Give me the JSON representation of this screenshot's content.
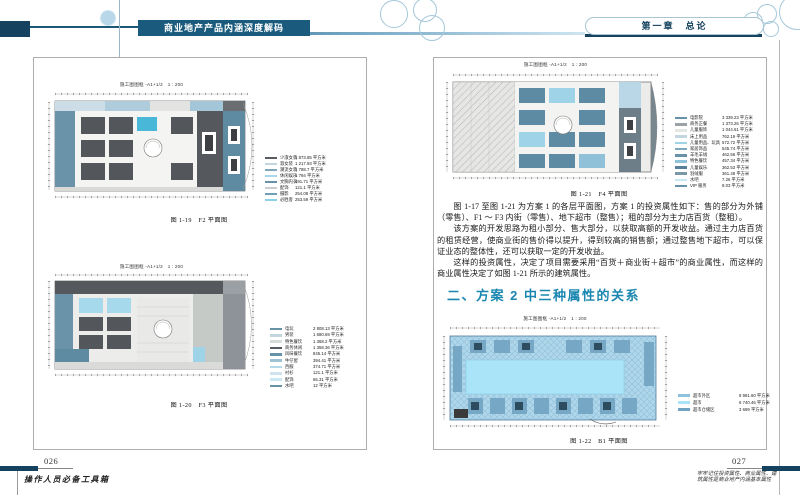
{
  "header": {
    "book_title": "商业地产产品内涵深度解码",
    "chapter_label": "第一章　总论"
  },
  "left_page": {
    "page_number": "026",
    "series_title": "操作人员必备工具箱",
    "figures": [
      {
        "plan_title": "施工图图框 -A1+1/2　1 : 200",
        "caption": "图 1-19　F2 平面图",
        "legend": [
          {
            "label": "少淑女装",
            "value": "1 873.85 平方米",
            "color": "#585c60"
          },
          {
            "label": "淑女装",
            "value": "1 217.93 平方米",
            "color": "#c3d6e0"
          },
          {
            "label": "潮流女装",
            "value": "1 788.7 平方米",
            "color": "#7fa7bb"
          },
          {
            "label": "休闲娱乐",
            "value": "1 794 平方米",
            "color": "#a9d6e8"
          },
          {
            "label": "文胸内衣",
            "value": "491.71 平方米",
            "color": "#6892a8"
          },
          {
            "label": "配饰",
            "value": "121.1 平方米",
            "color": "#c9cdcf"
          },
          {
            "label": "摄影",
            "value": "254.08 平方米",
            "color": "#6fa0b8"
          },
          {
            "label": "必胜客",
            "value": "253.59 平方米",
            "color": "#8ed0e6"
          }
        ]
      },
      {
        "plan_title": "施工图图框 -A1+1/2　1 : 200",
        "caption": "图 1-20　F3 平面图",
        "legend": [
          {
            "label": "电玩",
            "value": "2 808.13 平方米",
            "color": "#6892a8"
          },
          {
            "label": "男装",
            "value": "1 680.69 平方米",
            "color": "#c3d6e0"
          },
          {
            "label": "特色餐饮",
            "value": "1 368.2 平方米",
            "color": "#d8dcd8"
          },
          {
            "label": "商务休闲",
            "value": "1 358.36 平方米",
            "color": "#585c60"
          },
          {
            "label": "风味餐饮",
            "value": "845.14 平方米",
            "color": "#6892a8"
          },
          {
            "label": "牛仔屋",
            "value": "394.41 平方米",
            "color": "#9fc2d4"
          },
          {
            "label": "西服",
            "value": "374.71 平方米",
            "color": "#b7d8e8"
          },
          {
            "label": "衬衫",
            "value": "121.1 平方米",
            "color": "#cfe4ee"
          },
          {
            "label": "配饰",
            "value": "65.31 平方米",
            "color": "#c9e8f4"
          },
          {
            "label": "水吧",
            "value": "12 平方米",
            "color": "#6892a8"
          }
        ]
      }
    ]
  },
  "right_page": {
    "page_number": "027",
    "margin_note": [
      "牢牢记住投资属性、商业属性、建",
      "筑属性是商业地产内涵基本属性"
    ],
    "figure_f4": {
      "plan_title": "施工图图框 -A1+1/2　1 : 200",
      "caption": "图 1-21　F4 平面图",
      "legend": [
        {
          "label": "电影院",
          "value": "3 339.23 平方米",
          "color": "#6892a8"
        },
        {
          "label": "商务正餐",
          "value": "1 373.26 平方米",
          "color": "#9aa2a6"
        },
        {
          "label": "儿童服饰",
          "value": "1 044.61 平方米",
          "color": "#e4e6e4"
        },
        {
          "label": "床上用品",
          "value": "762.19 平方米",
          "color": "#c3d6e0"
        },
        {
          "label": "儿童用品、玩具",
          "value": "572.72 平方米",
          "color": "#9fd3e8"
        },
        {
          "label": "家居饰品",
          "value": "545.74 平方米",
          "color": "#7fa7bb"
        },
        {
          "label": "羊毛羊绒",
          "value": "462.56 平方米",
          "color": "#6892a8"
        },
        {
          "label": "特色餐饮",
          "value": "457.34 平方米",
          "color": "#8fc2d8"
        },
        {
          "label": "儿童娱乐",
          "value": "362.53 平方米",
          "color": "#58809a"
        },
        {
          "label": "羽绒服",
          "value": "361.48 平方米",
          "color": "#7b98a8"
        },
        {
          "label": "水吧",
          "value": "7.26 平方米",
          "color": "#c9e8f4"
        },
        {
          "label": "VIP 服务",
          "value": "8.03 平方米",
          "color": "#6892a8"
        }
      ]
    },
    "paragraphs": [
      "图 1-17 至图 1-21 为方案 1 的各层平面图，方案 1 的投资属性如下：售的部分为外铺（零售）、F1 ～ F3 内街（零售）、地下超市（整售）；租的部分为主力店百货（整租）。",
      "该方案的开发思路为租小部分、售大部分，以获取高额的开发收益。通过主力店百货的租赁经营，使商业街的售价得以提升，得到较高的销售额；通过整售地下超市，可以保证业态的整体性，还可以获取一定的开发收益。",
      "这样的投资属性，决定了项目需要采用“百货＋商业街＋超市”的商业属性，而这样的商业属性决定了如图 1-21 所示的建筑属性。"
    ],
    "section_heading": "二、方案 2 中三种属性的关系",
    "figure_b1": {
      "plan_title": "施工图图框 -A1+1/2　1 : 200",
      "caption": "图 1-22　B1 平面图",
      "legend": [
        {
          "label": "超市外区",
          "value": "8 981.60 平方米",
          "color": "#8fc2dd"
        },
        {
          "label": "超市",
          "value": "6 740.46 平方米",
          "color": "#a9e4f8"
        },
        {
          "label": "超市仓储区",
          "value": "3 699 平方米",
          "color": "#6fa3c2"
        }
      ]
    }
  },
  "colors": {
    "navy": "#14425f",
    "header_box": "#1a5b7d",
    "accent_teal": "#1b87b0"
  }
}
